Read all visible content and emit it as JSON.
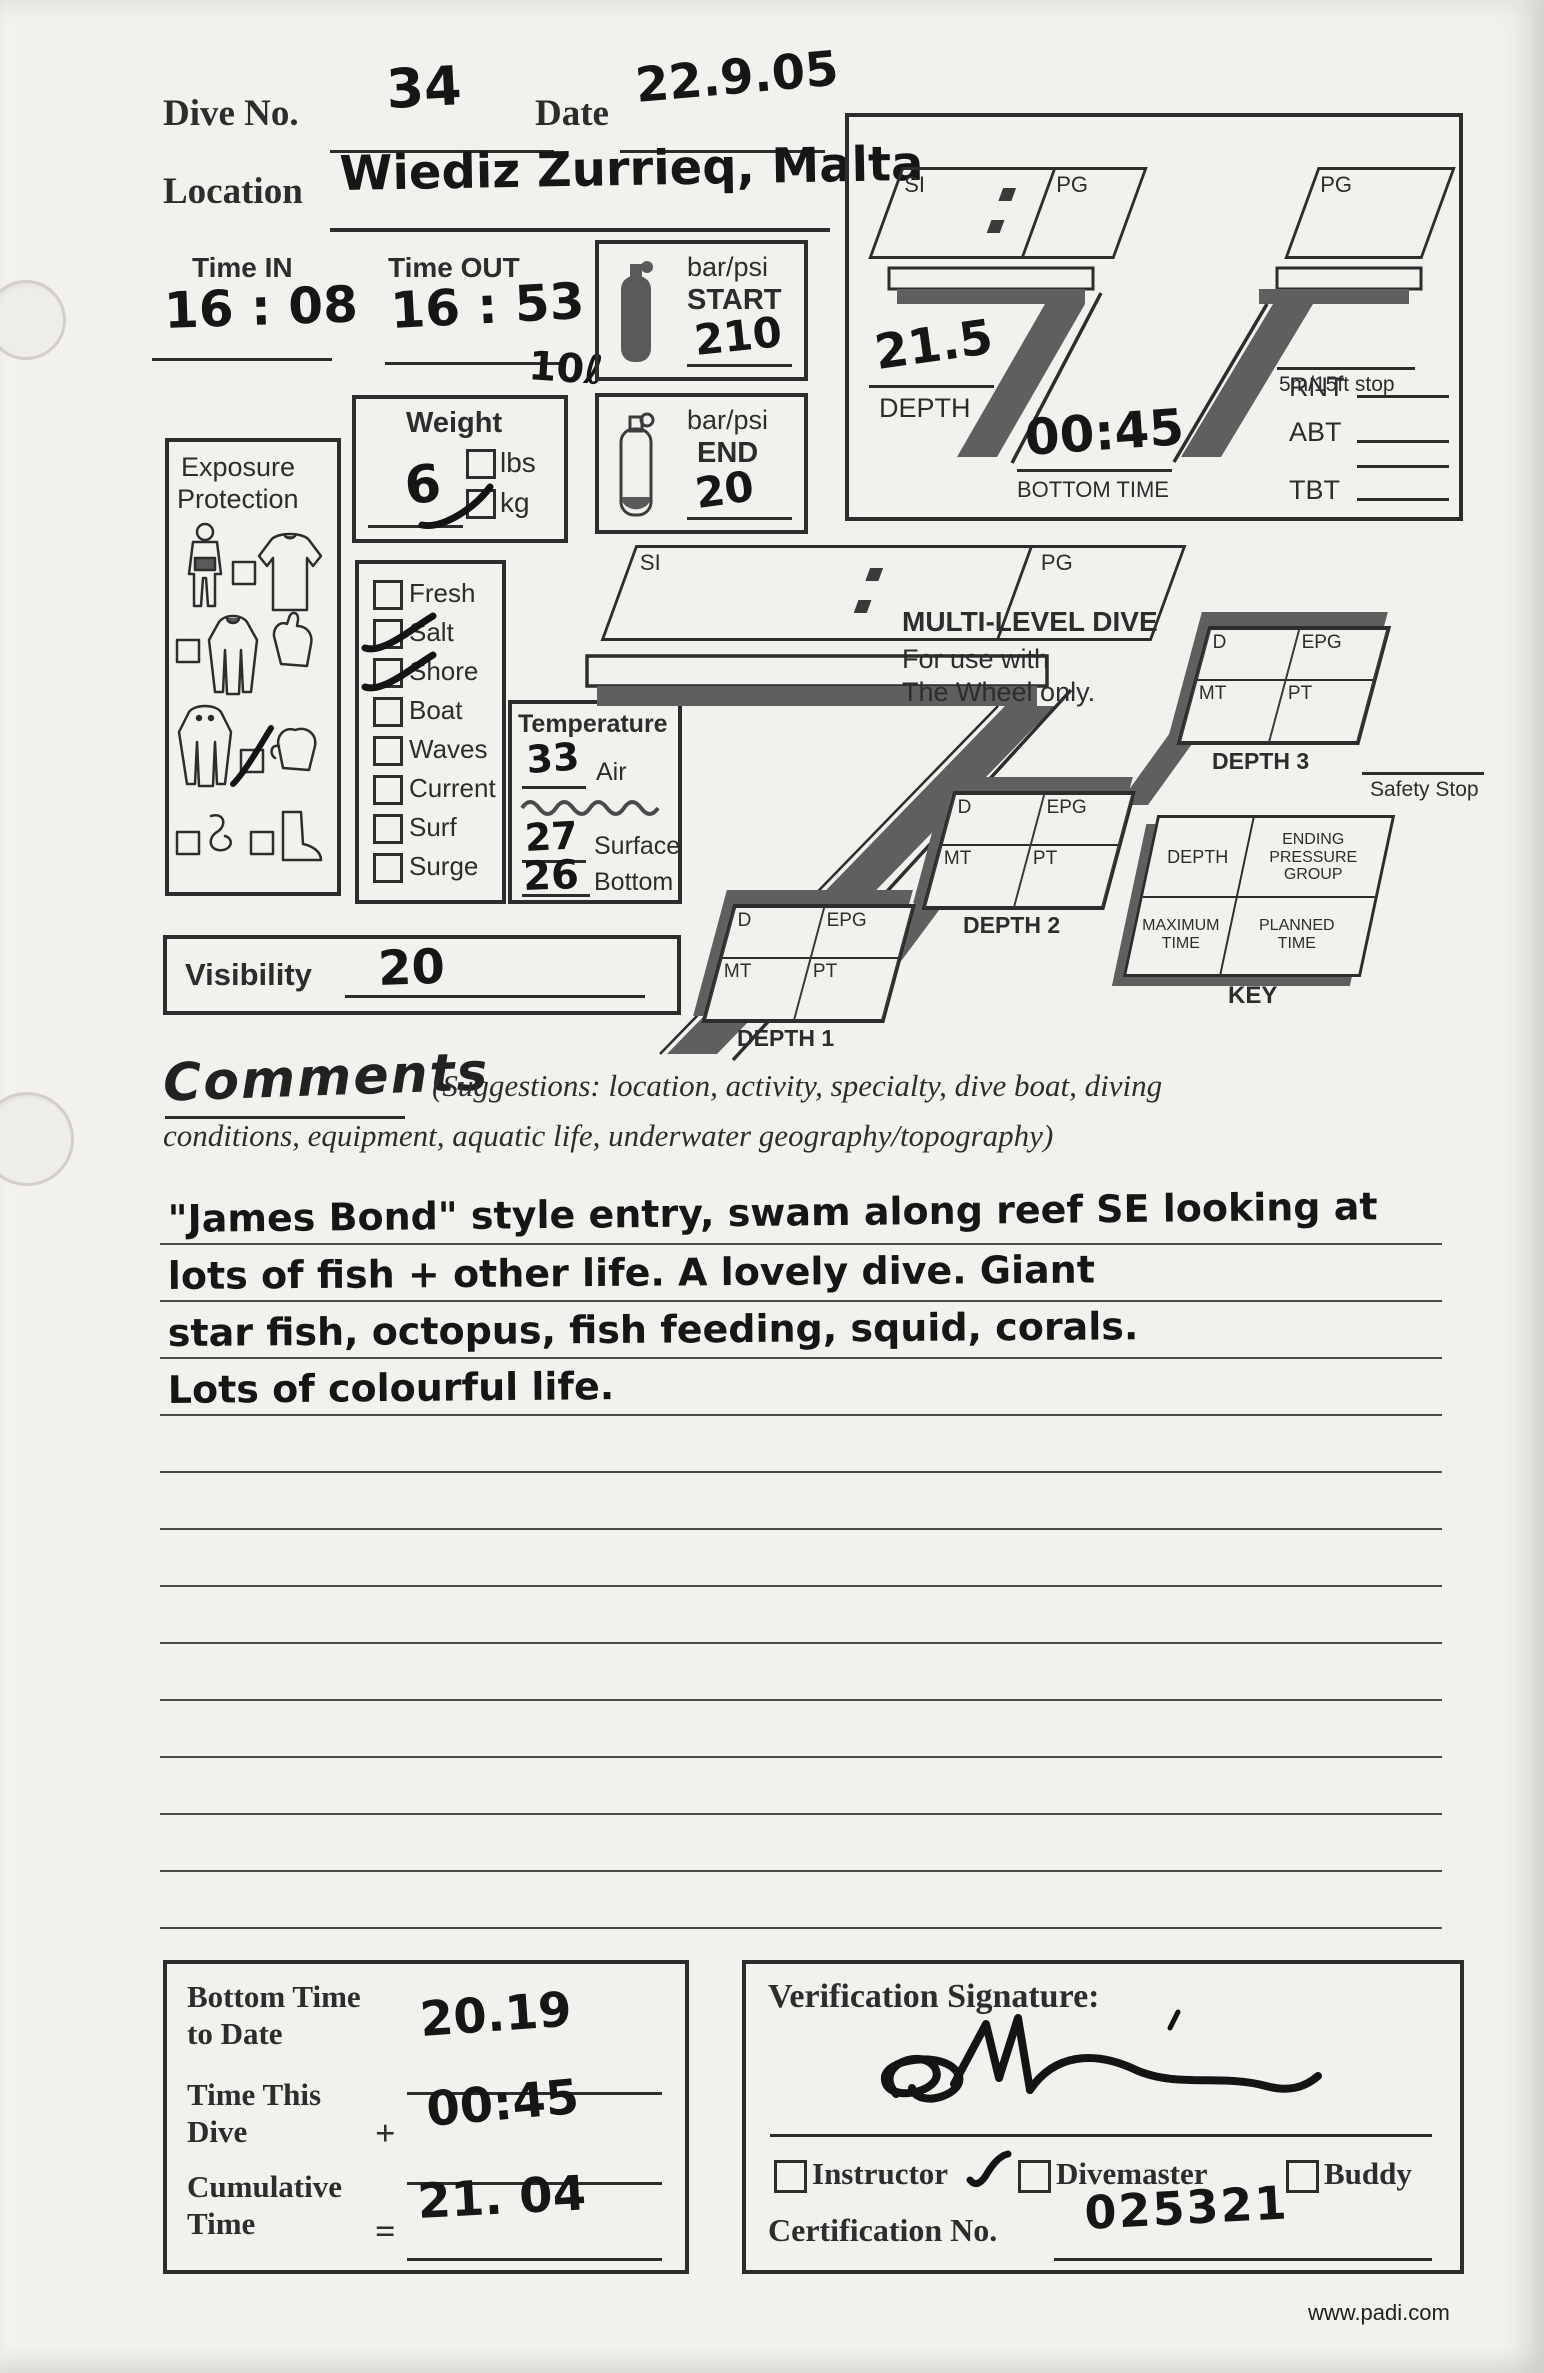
{
  "header": {
    "dive_no_label": "Dive No.",
    "dive_no_value": "34",
    "date_label": "Date",
    "date_value": "22.9.05",
    "location_label": "Location",
    "location_value": "Wiediz Zurrieq, Malta"
  },
  "times": {
    "time_in_label": "Time IN",
    "time_in_value": "16 : 08",
    "time_out_label": "Time OUT",
    "time_out_value": "16 : 53",
    "tank_volume_note": "10ℓ"
  },
  "pressure": {
    "unit_label": "bar/psi",
    "start_label": "START",
    "start_value": "210",
    "end_label": "END",
    "end_value": "20"
  },
  "weight": {
    "title": "Weight",
    "value": "6",
    "lbs_label": "lbs",
    "kg_label": "kg",
    "kg_checked": true
  },
  "exposure": {
    "title_line1": "Exposure",
    "title_line2": "Protection"
  },
  "water": {
    "items": [
      {
        "label": "Fresh",
        "checked": false
      },
      {
        "label": "Salt",
        "checked": true
      },
      {
        "label": "Shore",
        "checked": true
      },
      {
        "label": "Boat",
        "checked": false
      },
      {
        "label": "Waves",
        "checked": false
      },
      {
        "label": "Current",
        "checked": false
      },
      {
        "label": "Surf",
        "checked": false
      },
      {
        "label": "Surge",
        "checked": false
      }
    ]
  },
  "temperature": {
    "title": "Temperature",
    "air_value": "33",
    "air_label": "Air",
    "surface_value": "27",
    "surface_label": "Surface",
    "bottom_value": "26",
    "bottom_label": "Bottom"
  },
  "visibility": {
    "label": "Visibility",
    "value": "20"
  },
  "profile_box": {
    "si_label": "SI",
    "pg_label": "PG",
    "pg_repeat_label": "PG",
    "stop_label": "5m/15ft stop",
    "depth_value": "21.5",
    "depth_label": "DEPTH",
    "bottom_time_value": "00:45",
    "bottom_time_label": "BOTTOM TIME",
    "rnt_label": "RNT",
    "abt_label": "ABT",
    "tbt_label": "TBT"
  },
  "multilevel": {
    "si_label": "SI",
    "pg_label": "PG",
    "title": "MULTI-LEVEL DIVE",
    "subtitle_line1": "For use with",
    "subtitle_line2": "The Wheel only.",
    "cell_d_label": "D",
    "cell_epg_label": "EPG",
    "cell_mt_label": "MT",
    "cell_pt_label": "PT",
    "depth1_label": "DEPTH 1",
    "depth2_label": "DEPTH 2",
    "depth3_label": "DEPTH 3",
    "safety_stop_label": "Safety Stop",
    "key_depth_label": "DEPTH",
    "key_epg_label": "ENDING PRESSURE GROUP",
    "key_max_label": "MAXIMUM TIME",
    "key_planned_label": "PLANNED TIME",
    "key_label": "KEY"
  },
  "comments": {
    "title": "Comments",
    "suggestions_line1": "(Suggestions: location, activity, specialty, dive boat, diving",
    "suggestions_line2": "conditions, equipment, aquatic life, underwater geography/topography)",
    "lines": [
      "\"James Bond\" style entry, swam along reef SE looking at",
      "lots of fish + other life. A lovely dive. Giant",
      "star fish, octopus, fish feeding, squid, corals.",
      "Lots of colourful life."
    ]
  },
  "totals": {
    "bottom_time_to_date_label": "Bottom Time to Date",
    "bottom_time_to_date_value": "20.19",
    "time_this_dive_label": "Time This Dive",
    "plus_sign": "+",
    "time_this_dive_value": "00:45",
    "cumulative_label": "Cumulative Time",
    "equals_sign": "=",
    "cumulative_value": "21. 04"
  },
  "verification": {
    "title": "Verification Signature:",
    "roles": [
      {
        "label": "Instructor",
        "checked": true
      },
      {
        "label": "Divemaster",
        "checked": false
      },
      {
        "label": "Buddy",
        "checked": false
      }
    ],
    "cert_label": "Certification No.",
    "cert_value": "025321"
  },
  "footer": {
    "website": "www.padi.com"
  },
  "colors": {
    "ink": "#2d2d2d",
    "handwriting": "#161616",
    "gray_fill": "#5f5f5f",
    "paper": "#f3f1ed"
  }
}
